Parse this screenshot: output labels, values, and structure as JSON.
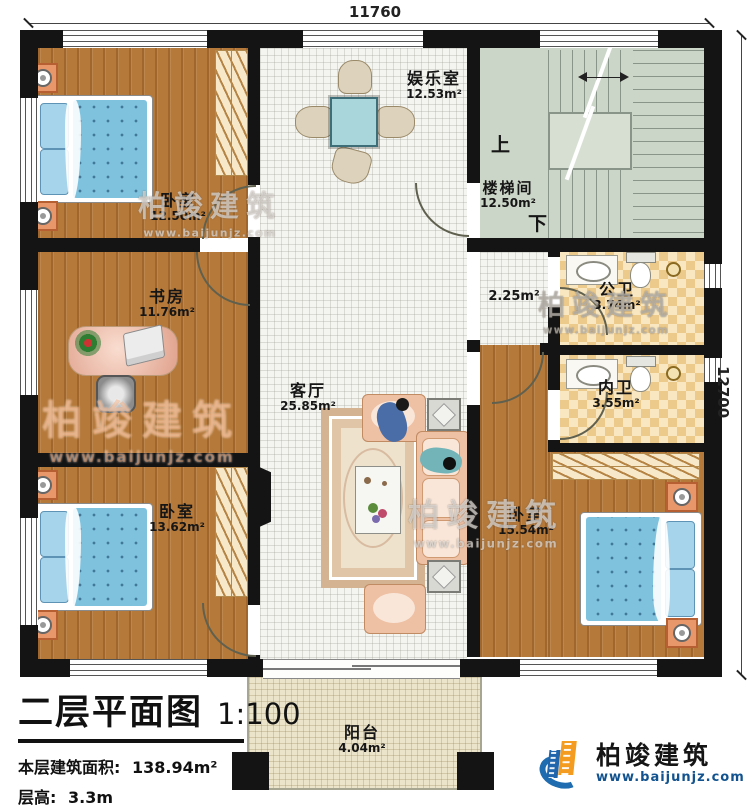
{
  "plan": {
    "dimension_top": "11760",
    "dimension_right": "12700"
  },
  "rooms": [
    {
      "name": "卧室",
      "area": "12.50m²"
    },
    {
      "name": "书房",
      "area": "11.76m²"
    },
    {
      "name": "卧室",
      "area": "13.62m²"
    },
    {
      "name": "娱乐室",
      "area": "12.53m²"
    },
    {
      "name": "客厅",
      "area": "25.85m²"
    },
    {
      "name": "楼梯间",
      "area": "12.50m²"
    },
    {
      "name": "公卫",
      "area": "3.74m²"
    },
    {
      "name": "内卫",
      "area": "3.55m²"
    },
    {
      "name": "卧室",
      "area": "15.54m²"
    },
    {
      "name": "阳台",
      "area": "4.04m²"
    },
    {
      "name": "",
      "area": "2.25m²"
    }
  ],
  "stairs": {
    "up": "上",
    "down": "下"
  },
  "title_block": {
    "title": "二层平面图",
    "scale": "1:100",
    "floor_area_label": "本层建筑面积:",
    "floor_area_value": "138.94m²",
    "floor_height_label": "层高:",
    "floor_height_value": "3.3m"
  },
  "branding": {
    "company": "柏竣建筑",
    "website": "www.baijunjz.com"
  },
  "watermark": {
    "text": "柏竣建筑",
    "url": "www.baijunjz.com"
  },
  "colors": {
    "wall": "#141414",
    "wood_floor": "#b5793a",
    "hall_floor": "#f4f4f0",
    "stair_floor": "#ccd6c8",
    "bath_floor": "#ecca8c",
    "balcony_floor": "#ece4ca",
    "bed": "#7fc2de",
    "sofa": "#eec0a4",
    "brand_blue": "#1f6cb0",
    "brand_orange": "#f39c1f"
  }
}
